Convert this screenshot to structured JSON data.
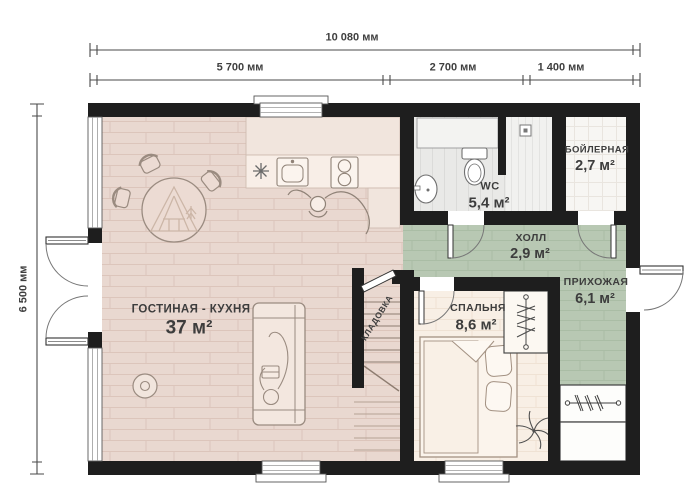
{
  "plan": {
    "dimensions": {
      "total_width": "10 080 мм",
      "width_segments": [
        "5 700 мм",
        "2 700 мм",
        "1 400 мм"
      ],
      "total_height": "6 500 мм"
    },
    "rooms": {
      "living_kitchen": {
        "name": "ГОСТИНАЯ - КУХНЯ",
        "area": "37 м²"
      },
      "wc": {
        "name": "WC",
        "area": "5,4 м²"
      },
      "boiler": {
        "name": "БОЙЛЕРНАЯ",
        "area": "2,7 м²"
      },
      "hall": {
        "name": "ХОЛЛ",
        "area": "2,9 м²"
      },
      "entry": {
        "name": "ПРИХОЖАЯ",
        "area": "6,1 м²"
      },
      "bedroom": {
        "name": "СПАЛЬНЯ",
        "area": "8,6 м²"
      },
      "storage": {
        "name": "КЛАДОВКА"
      }
    },
    "symbols": [
      "dining-table",
      "chair",
      "sofa",
      "person-on-sofa",
      "person-at-counter",
      "cabin-logo",
      "fridge-snowflake",
      "kitchen-sink",
      "stove",
      "floor-pouf",
      "toilet",
      "washbasin",
      "shower-drain",
      "bed",
      "pillows",
      "hanger-rail",
      "plant",
      "stairs",
      "door-swing",
      "window"
    ],
    "colors": {
      "wall": "#1e1e1e",
      "living_floor": "#e9d8d0",
      "green_floor": "#b8c8b3",
      "bedroom_floor": "#f8efe5",
      "wc_floor": "#e9e9e7",
      "boiler_floor": "#f7f6f3",
      "text": "#3d3d3d"
    }
  }
}
